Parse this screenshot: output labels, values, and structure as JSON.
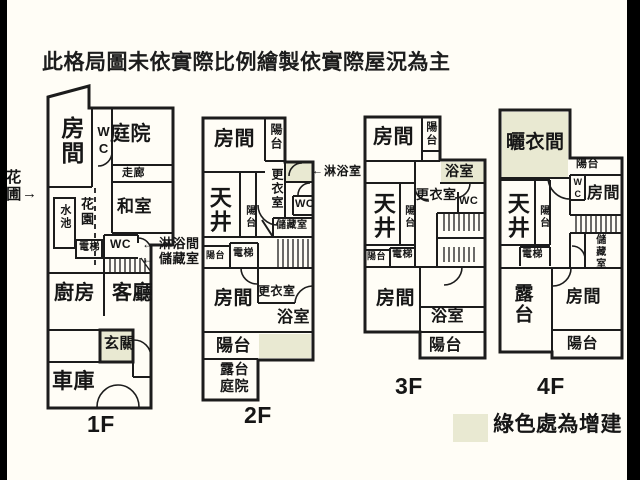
{
  "title": "此格局圖未依實際比例繪製依實際屋況為主",
  "colors": {
    "highlight": "#e9e9d2",
    "wall": "#1c1c1c",
    "background": "#fffdf6",
    "letterbox": "#000000"
  },
  "icons": {
    "arrow_right": "→",
    "arrow_left": "←"
  },
  "legend": {
    "label": "綠色處為增建",
    "swatch_color": "#e9e9d2"
  },
  "floors": {
    "f1": {
      "label": "1F",
      "rooms": {
        "bedroom": "房間",
        "wc_top": "WC",
        "courtyard": "庭院",
        "corridor": "走廊",
        "pond": "水池",
        "garden": "花園",
        "tatami": "和室",
        "wc": "WC",
        "elevator": "電梯",
        "kitchen": "廚房",
        "living": "客廳",
        "entry": "玄關",
        "garage": "車庫"
      },
      "callouts": {
        "flower_bed": "花圃",
        "shower": "淋浴間",
        "storage": "儲藏室"
      }
    },
    "f2": {
      "label": "2F",
      "rooms": {
        "bedroom_top": "房間",
        "balcony_top": "陽台",
        "dressing_top": "更衣室",
        "wc": "WC",
        "atrium": "天井",
        "balcony_mid": "陽台",
        "storage": "儲藏室",
        "balcony_small": "陽台",
        "elevator": "電梯",
        "bedroom_bottom": "房間",
        "dressing_bottom": "更衣室",
        "bath": "浴室",
        "balcony_bottom": "陽台",
        "terrace": "露台",
        "terrace_court": "庭院"
      },
      "callouts": {
        "shower": "淋浴室"
      }
    },
    "f3": {
      "label": "3F",
      "rooms": {
        "bedroom_top": "房間",
        "balcony_top": "陽台",
        "bath_top": "浴室",
        "dressing": "更衣室",
        "wc": "WC",
        "atrium": "天井",
        "balcony_mid": "陽台",
        "balcony_small": "陽台",
        "elevator": "電梯",
        "bedroom_bottom": "房間",
        "bath_bottom": "浴室",
        "balcony_bottom": "陽台"
      }
    },
    "f4": {
      "label": "4F",
      "rooms": {
        "drying_room": "曬衣間",
        "balcony_top": "陽台",
        "wc": "WC",
        "bedroom_top": "房間",
        "atrium": "天井",
        "balcony_mid": "陽台",
        "elevator": "電梯",
        "storage": "儲藏室",
        "terrace": "露台",
        "bedroom_bottom": "房間",
        "balcony_bottom": "陽台"
      }
    }
  }
}
